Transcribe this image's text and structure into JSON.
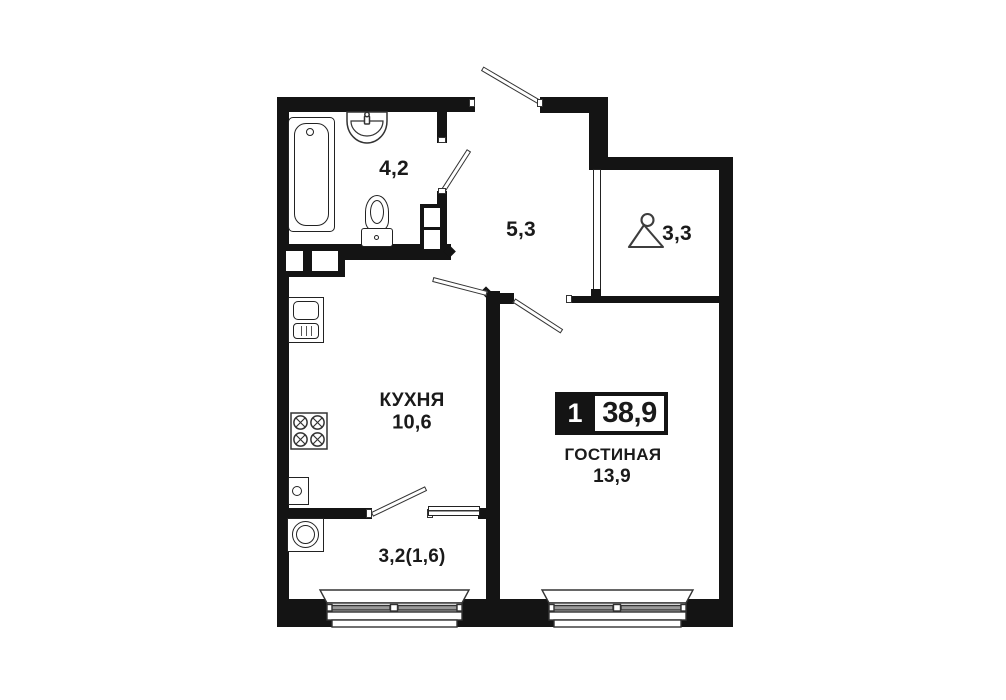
{
  "badge": {
    "rooms_count": "1",
    "total_area": "38,9"
  },
  "rooms": {
    "bathroom": {
      "area": "4,2"
    },
    "hallway": {
      "area": "5,3"
    },
    "wardrobe": {
      "area": "3,3"
    },
    "kitchen": {
      "name": "КУХНЯ",
      "area": "10,6"
    },
    "living": {
      "name": "ГОСТИНАЯ",
      "area": "13,9"
    },
    "balcony": {
      "area": "3,2(1,6)"
    }
  },
  "icons": {
    "wardrobe": "hanger-icon",
    "bathroom": [
      "bathtub-icon",
      "wash-basin-icon",
      "toilet-icon"
    ],
    "kitchen": [
      "kitchen-sink-icon",
      "stove-icon",
      "boiler-icon"
    ],
    "balcony": [
      "washing-machine-icon"
    ]
  },
  "colors": {
    "wall": "#141414",
    "background": "#ffffff",
    "glass": "#9a9a9a"
  }
}
